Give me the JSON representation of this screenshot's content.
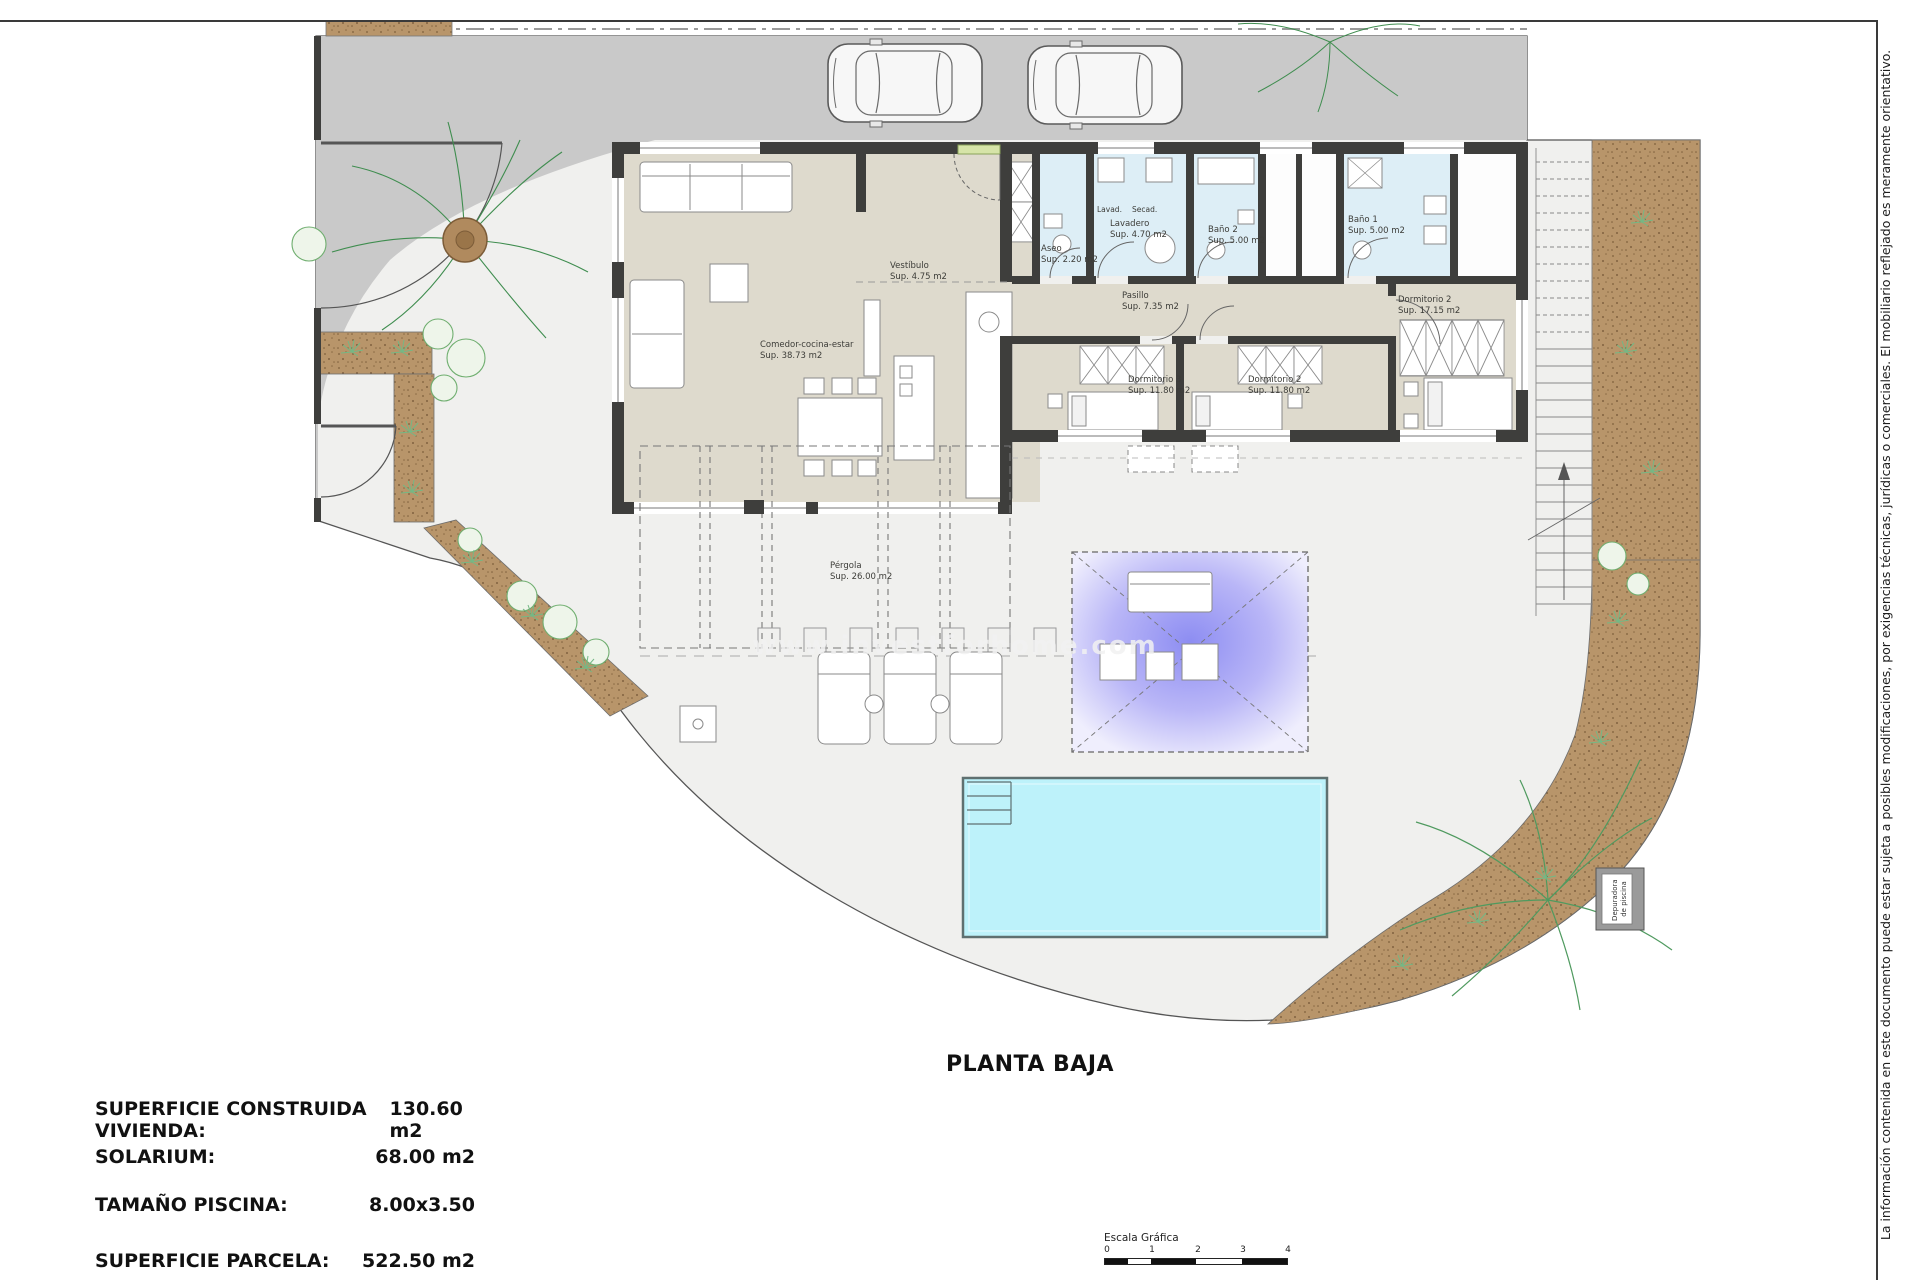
{
  "sheet": {
    "plan_title": "PLANTA BAJA",
    "watermark": "www.investforhome.com",
    "disclaimer": "La información contenida en este documento puede estar sujeta a posibles modificaciones, por exigencias técnicas, jurídicas o comerciales. El mobiliario reflejado es meramente orientativo.",
    "summary_rows": [
      {
        "label": "SUPERFICIE CONSTRUIDA VIVIENDA:",
        "value": "130.60 m2"
      },
      {
        "label": "SOLARIUM:",
        "value": "68.00 m2"
      },
      {
        "label": "TAMAÑO PISCINA:",
        "value": "8.00x3.50"
      },
      {
        "label": "SUPERFICIE PARCELA:",
        "value": "522.50 m2"
      }
    ],
    "scale_bar": {
      "caption": "Escala Gráfica",
      "ticks": [
        "0",
        "1",
        "2",
        "3",
        "4"
      ]
    }
  },
  "rooms": {
    "living": {
      "name": "Comedor-cocina-estar",
      "area": "Sup. 38.73 m2"
    },
    "vestibulo": {
      "name": "Vestíbulo",
      "area": "Sup. 4.75 m2"
    },
    "aseo": {
      "name": "Aseo",
      "area": "Sup. 2.20 m2"
    },
    "lavadero": {
      "name": "Lavadero",
      "area": "Sup. 4.70 m2"
    },
    "bano2": {
      "name": "Baño 2",
      "area": "Sup. 5.00 m2"
    },
    "bano1": {
      "name": "Baño 1",
      "area": "Sup. 5.00 m2"
    },
    "pasillo": {
      "name": "Pasillo",
      "area": "Sup. 7.35 m2"
    },
    "dorm3": {
      "name": "Dormitorio 3",
      "area": "Sup. 11.80 m2"
    },
    "dorm2": {
      "name": "Dormitorio 2",
      "area": "Sup. 11.80 m2"
    },
    "dorm1": {
      "name": "Dormitorio 2",
      "area": "Sup. 17.15 m2"
    },
    "pergola": {
      "name": "Pérgola",
      "area": "Sup. 26.00 m2"
    }
  },
  "labels": {
    "washer": "Lavad.",
    "dryer": "Secad.",
    "pool_equipment_line1": "Depuradora",
    "pool_equipment_line2": "de piscina"
  },
  "colors": {
    "driveway": "#c9c9c9",
    "parcel": "#f0f0ee",
    "floor_beige": "#dedacd",
    "floor_wet": "#ddeef6",
    "wall": "#3e3e3c",
    "sand": "#b8956a",
    "pool": "#bdf2fa",
    "shade_sail": "#8d8df2",
    "plant_green": "#5f9e5f"
  }
}
